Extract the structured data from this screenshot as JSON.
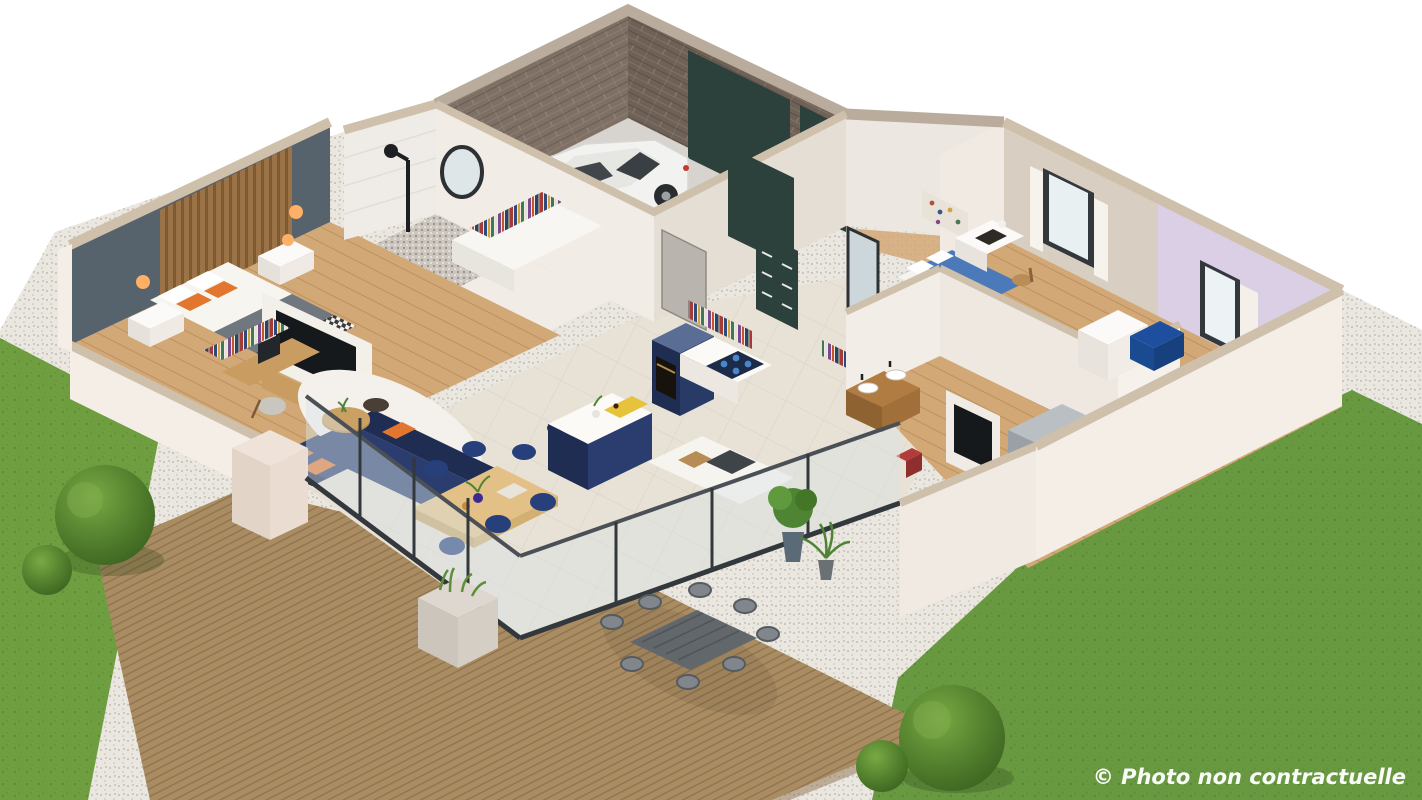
{
  "watermark": {
    "text": "© Photo non contractuelle"
  },
  "colors": {
    "background": "#ffffff",
    "grass": "#6f9e40",
    "grass_right": "#689941",
    "bush": "#4e7f2b",
    "bush_light": "#66973a",
    "gravel": "#eae6e0",
    "deck": "#a98c62",
    "deck_edge": "#8f7450",
    "wall_white": "#f1ece5",
    "wall_shade": "#e5ded4",
    "wall_outer": "#f4eee7",
    "cap": "#cfc0ab",
    "cap_stone": "#b9ac9c",
    "brick": "#7e7065",
    "brick_dark": "#6f6156",
    "concrete": "#d7d3ce",
    "tile_floor": "#e8e1d6",
    "oak_floor": "#d2a876",
    "slate_wall": "#56626c",
    "wood_slats": "#9c7347",
    "navy_sofa": "#2b3d6e",
    "navy_dark": "#1f2d52",
    "navy_chair": "#27407c",
    "orange_accent": "#e2762e",
    "door_green": "#2c403c",
    "glass": "#d9e4e7",
    "frame_dark": "#32383c",
    "lavender_wall": "#dacfe4",
    "beige_wall": "#d9cec2",
    "blue_bed": "#4b79b9",
    "blue_armchair": "#1e4f9e",
    "pink_blanket": "#c98f96",
    "mauve_pillow": "#b97c85",
    "vanity_wood": "#b07c42",
    "oak_furniture": "#c99d62",
    "metal_grey": "#9aa0a5",
    "plant_green": "#4f8435",
    "yellow_runner": "#e6c33b",
    "lamp_glow": "#ffb066",
    "tv_screen": "#16191c",
    "car_body": "#f2f2f0",
    "red_chair": "#b23c3a",
    "watermark": "#ffffff"
  }
}
